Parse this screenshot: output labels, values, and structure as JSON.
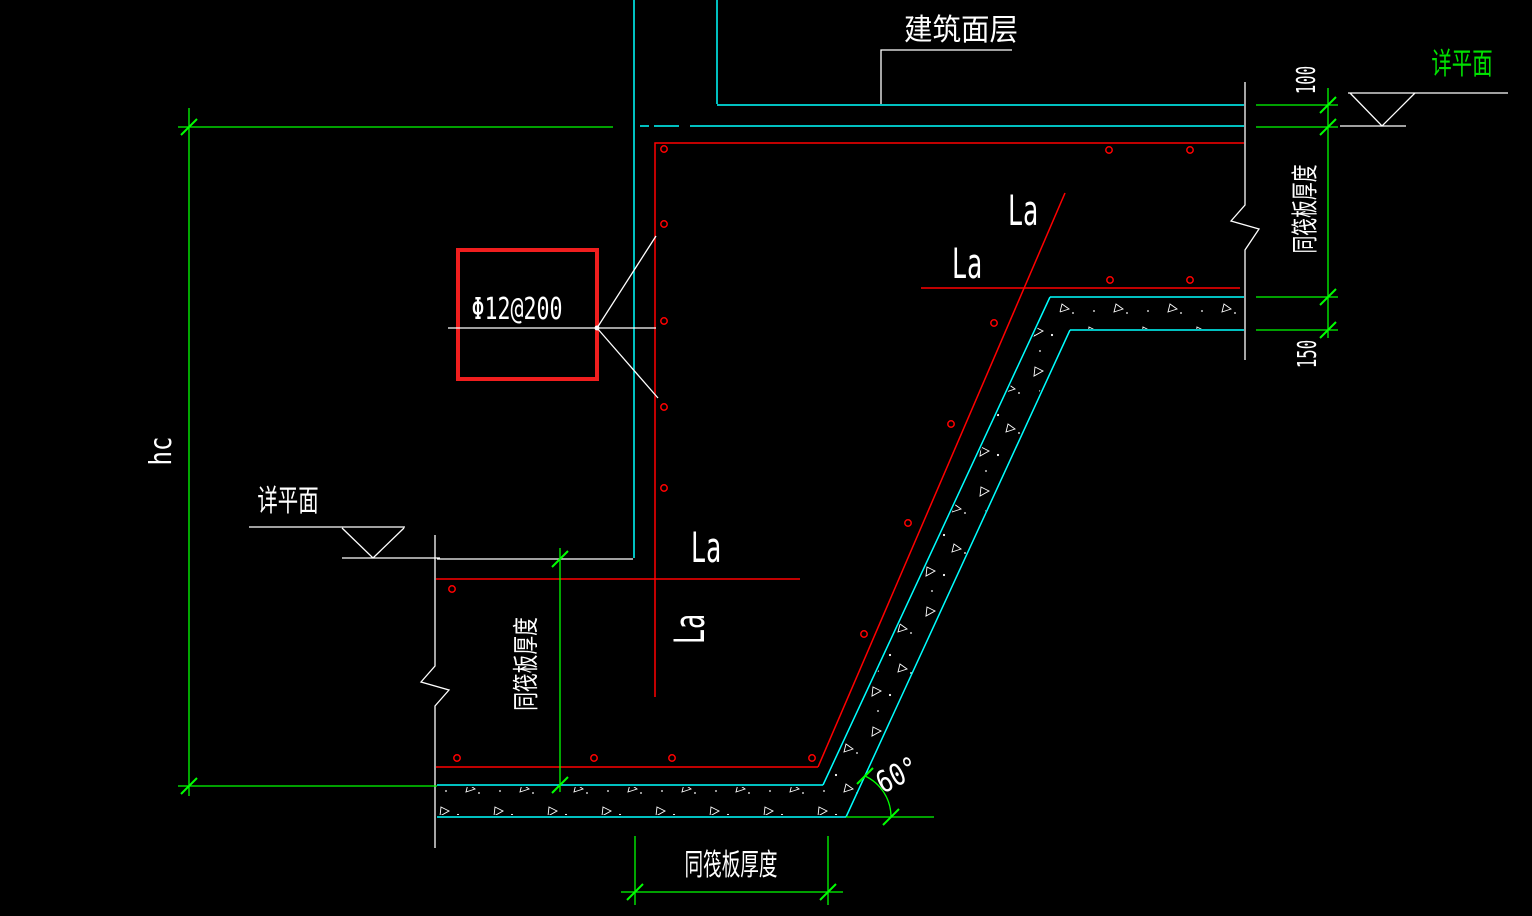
{
  "drawing": {
    "type": "structural-detail-cad-drawing",
    "notes": {
      "finish_layer": "建筑面层",
      "plan_reference_right": "详平面",
      "plan_reference_left": "详平面",
      "rebar_callout": "Φ12@200"
    },
    "anchorage_labels": {
      "top_1": "La",
      "top_2": "La",
      "mid_horizontal": "La",
      "mid_vertical": "La"
    },
    "dimensions": {
      "finish_thickness": "100",
      "bedding_thickness": "150",
      "raft_thickness_right": "同筏板厚度",
      "raft_thickness_left": "同筏板厚度",
      "raft_thickness_bottom": "同筏板厚度",
      "pit_depth": "hc",
      "slope_angle": "60°"
    },
    "colors": {
      "background": "#000000",
      "concrete_outline": "#00ffff",
      "rebar": "#ff0000",
      "dimension": "#00ff00",
      "annotation": "#ffffff",
      "plan_ref_accent": "#00e100",
      "callout_box": "#f01e1e"
    }
  }
}
